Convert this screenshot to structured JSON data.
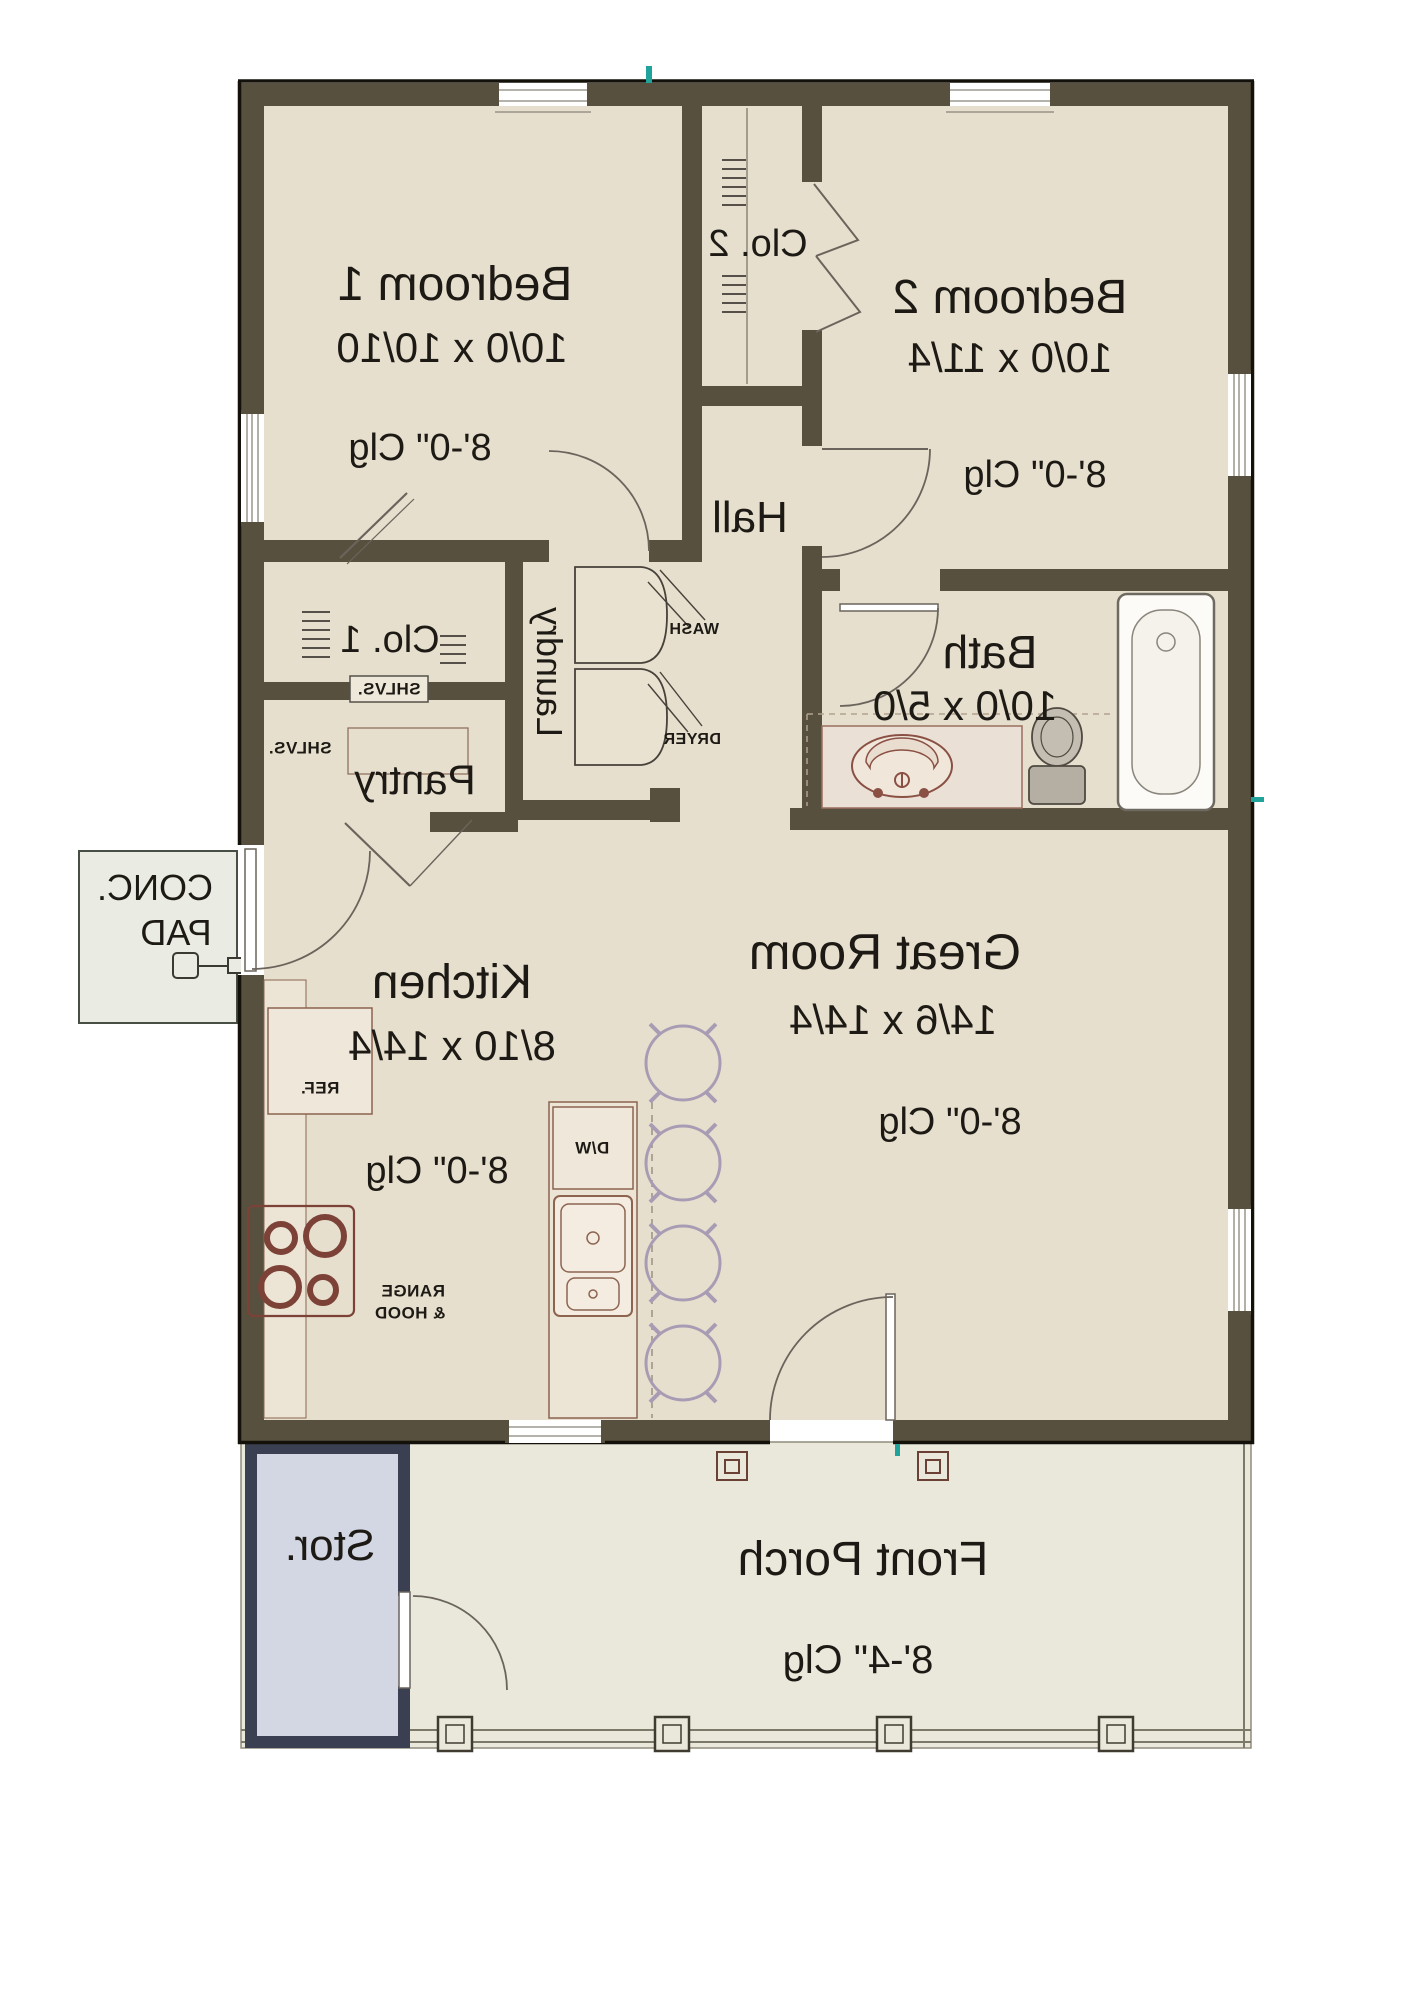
{
  "plan_type": "floor-plan",
  "mirrored": true,
  "rooms": {
    "bedroom1": {
      "name": "Bedroom 1",
      "dims": "10/0 x 10/10",
      "clg": "8'-0\" Clg"
    },
    "bedroom2": {
      "name": "Bedroom 2",
      "dims": "10/0 x 11/4",
      "clg": "8'-0\" Clg"
    },
    "closet2": {
      "name": "Clo. 2"
    },
    "hall": {
      "name": "Hall"
    },
    "closet1": {
      "name": "Clo. 1",
      "shelves": "SHLVS."
    },
    "laundry": {
      "name": "Laundry",
      "washer": "WASH",
      "dryer": "DRYER"
    },
    "pantry": {
      "name": "Pantry",
      "shelves": "SHLVS."
    },
    "bath": {
      "name": "Bath",
      "dims": "10/0 x 5/0"
    },
    "kitchen": {
      "name": "Kitchen",
      "dims": "8/10 x 14/4",
      "clg": "8'-0\" Clg",
      "fridge": "REF.",
      "range_line1": "RANGE",
      "range_line2": "& HOOD",
      "dishwasher": "D/W"
    },
    "great_room": {
      "name": "Great Room",
      "dims": "14/6 x 14/4",
      "clg": "8'-0\" Clg"
    },
    "conc_pad": {
      "line1": "CONC.",
      "line2": "PAD"
    },
    "storage": {
      "name": "Stor."
    },
    "porch": {
      "name": "Front Porch",
      "clg": "8'-4\" Clg"
    }
  },
  "colors": {
    "floor": "#e6dfcd",
    "wall": "#57503e",
    "outline": "#14100a",
    "porch_floor": "#eae8db",
    "storage_floor": "#d3d7e3",
    "storage_wall": "#3a4051",
    "pad_fill": "#eaece3",
    "fixture_maroon": "#8a5044",
    "stool_purple": "#a79cb4",
    "accent_teal": "#1fa39a"
  }
}
